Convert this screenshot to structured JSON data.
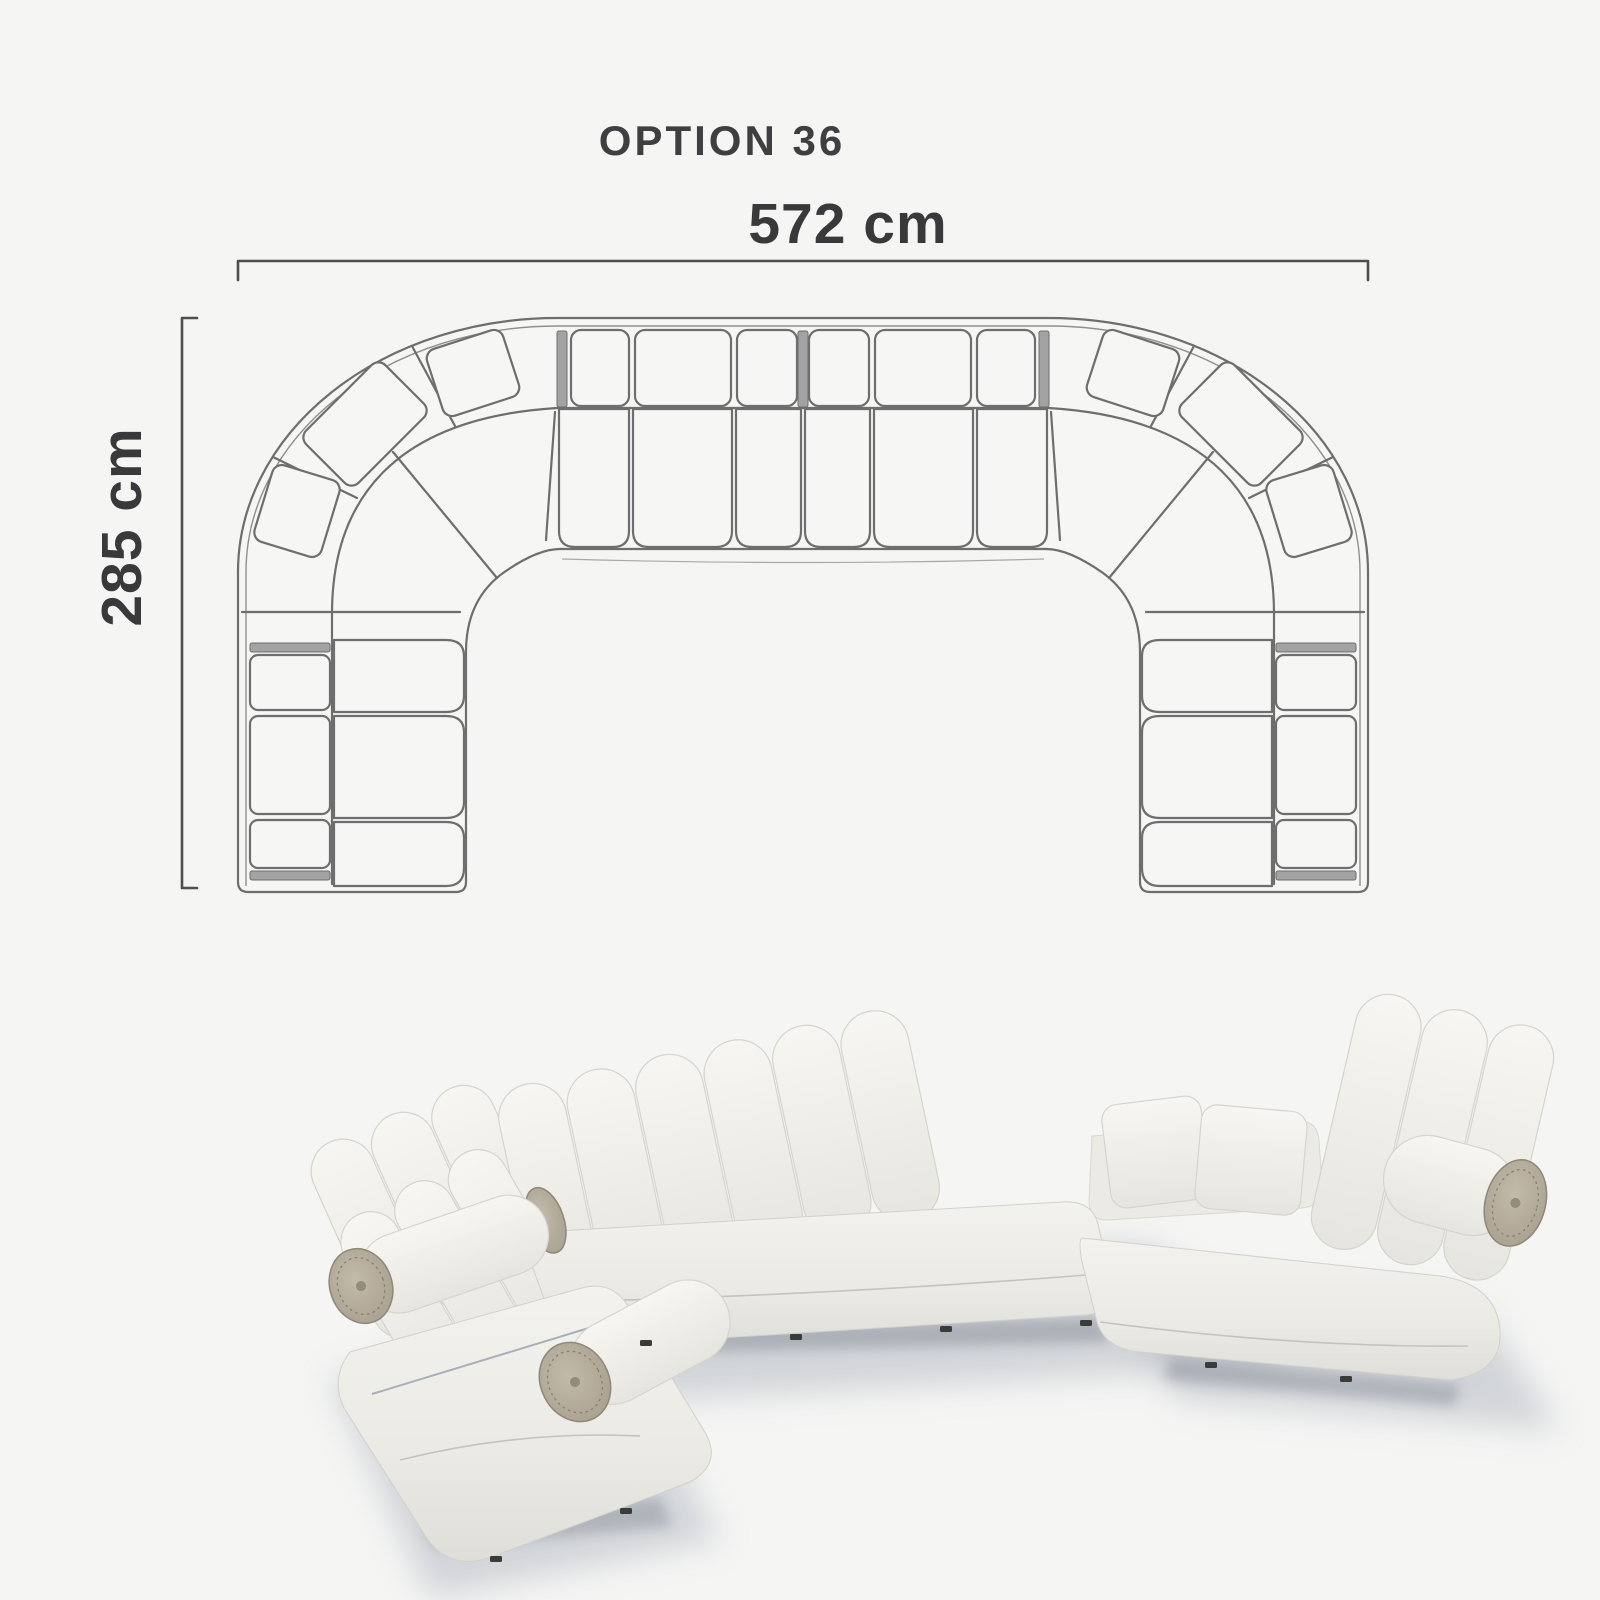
{
  "image": {
    "background_color": "#f5f5f4"
  },
  "diagram": {
    "title": "OPTION 36",
    "width_label": "572 cm",
    "depth_label": "285 cm",
    "line_color": "#6e6e6e",
    "dimension_line_color": "#4e4e4e",
    "text_color": "#3f3f41"
  },
  "render": {
    "fabric_color": "#f0efe9",
    "bolster_cap_color": "#b2a998",
    "shadow_color": "#aeb4bd"
  }
}
